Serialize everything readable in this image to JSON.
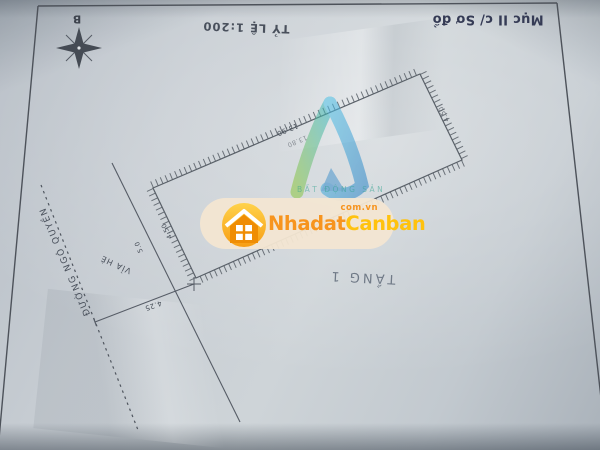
{
  "sketch": {
    "section_label": "Mục II c/ Sơ đồ",
    "scale_label": "TỶ LỆ 1:200",
    "compass_north_label": "B",
    "floor_label": "TẦNG 1",
    "street_name": "ĐƯỜNG NGÔ QUYỀN",
    "sidewalk_label": "VỈA HÈ",
    "dimensions": {
      "top_edge": "13.90",
      "top_edge_inner": "13.80",
      "left_edge": "4.50",
      "right_edge": "4.50",
      "sidewalk_width": "4.25",
      "setback": "5.0"
    }
  },
  "watermark": {
    "brand_part1": "Nhadat",
    "brand_part2": "Canban",
    "brand_domain": "com.vn",
    "logo_caption": "BẤT ĐỘNG SẢN",
    "colors": {
      "orange": "#f7941e",
      "yellow": "#ffc20e",
      "logo_green": "#7dc242",
      "logo_blue": "#2e9fd4",
      "pill_background": "#f3e6d2"
    }
  }
}
